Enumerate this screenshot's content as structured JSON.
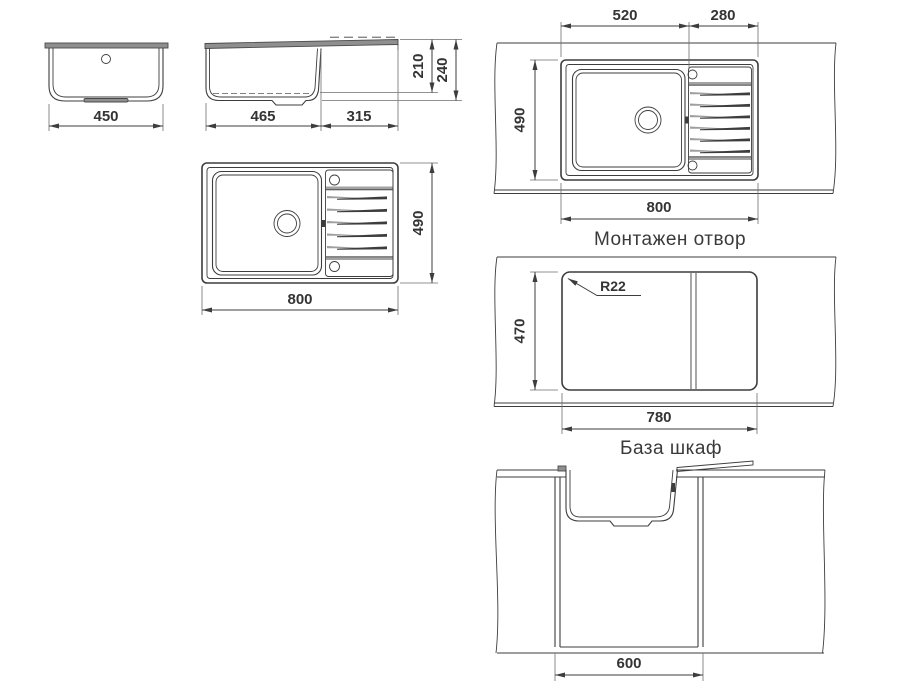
{
  "drawing": {
    "front_view": {
      "width": "450"
    },
    "side_view": {
      "bowl_width": "465",
      "drainer_width": "315",
      "bowl_depth": "210",
      "overall_depth": "240"
    },
    "plan_view": {
      "width": "800",
      "depth": "490"
    },
    "mounting_view": {
      "bowl_width": "520",
      "drainer_width": "280",
      "depth": "490",
      "width": "800",
      "caption": "Монтажен отвор"
    },
    "cutout_view": {
      "depth": "470",
      "width": "780",
      "corner_radius": "R22",
      "caption": "База шкаф"
    },
    "cabinet_view": {
      "width": "600"
    }
  },
  "colors": {
    "line": "#3d3d3d",
    "rim_fill": "#8f8f8f",
    "groove_gray": "#9f9f9f",
    "drain_fill": "#cbcbcb",
    "background": "#ffffff"
  }
}
